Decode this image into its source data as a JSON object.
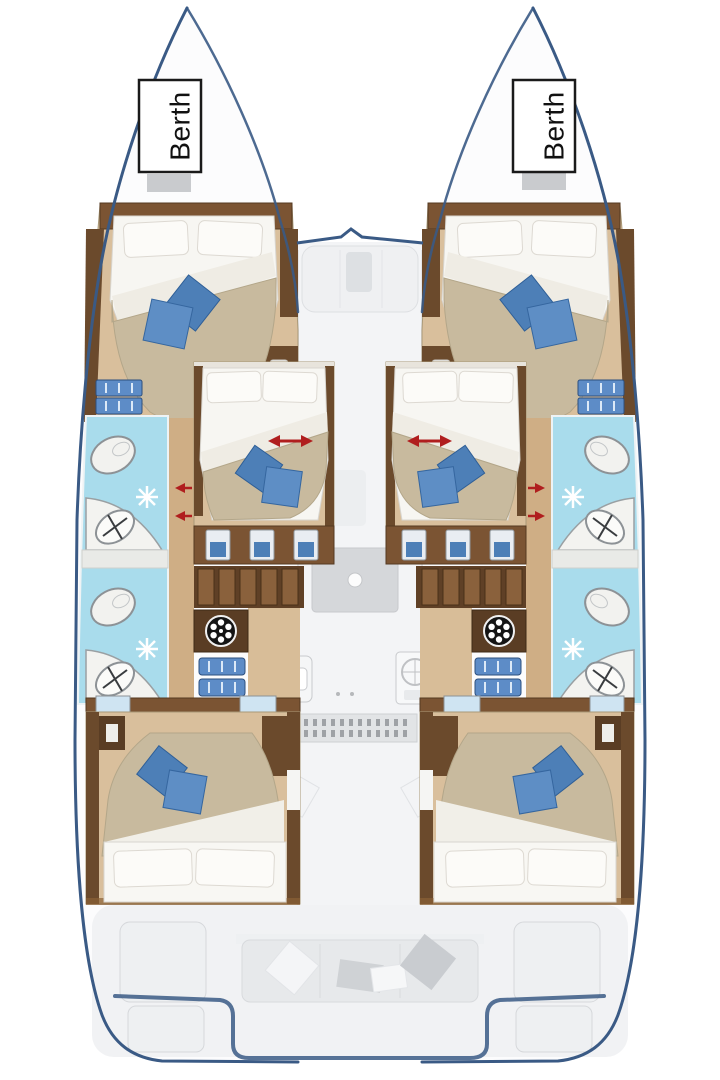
{
  "page": {
    "type": "catamaran-interior-deck-plan",
    "background": "#ffffff",
    "width_px": 720,
    "height_px": 1080
  },
  "labels": {
    "port_berth": "Berth",
    "starboard_berth": "Berth"
  },
  "colors": {
    "hull_outline": "#3a5a85",
    "hull_fill": "#fcfcfd",
    "deck_ghost": "#f2f3f5",
    "deck_furniture": "#d5d7da",
    "wood_wall_dark": "#5f4026",
    "wood_wall": "#6b4a2c",
    "wood_wall_light": "#7b5433",
    "wood_floor": "#d9bf9c",
    "wood_corridor": "#cfae85",
    "bed_linen": "#f7f6f2",
    "bed_duvet": "#c8ba9e",
    "pillow_blue": "#4d7fb7",
    "pillow_blue_light": "#5e8ec5",
    "pillow_gray": "#cfd2d5",
    "bath_floor": "#a9dcec",
    "fixture_white": "#f3f3f0",
    "steps_blue": "#5d8cc7",
    "arrow_red": "#b01e1e",
    "label_box_border": "#1a1a1a",
    "berth_block_gray": "#c9cbce"
  },
  "icons": [
    "toilet-icon",
    "sink-basin-icon",
    "shower-starburst-icon",
    "washing-machine-icon",
    "stove-burner-icon",
    "galley-sink-icon",
    "companionway-steps-icon",
    "slide-direction-arrow-icon",
    "door-arrow-icon"
  ],
  "rooms": {
    "port_hull": [
      "forepeak-berth",
      "forward-cabin",
      "forward-bathroom",
      "aft-bathroom",
      "midship-cabin",
      "aft-cabin"
    ],
    "starboard_hull": [
      "forepeak-berth",
      "forward-cabin",
      "forward-bathroom",
      "aft-bathroom",
      "midship-cabin",
      "aft-cabin"
    ],
    "center": [
      "foredeck-seat",
      "saloon-table",
      "galley",
      "nav-instrument-panel",
      "aft-cockpit-bench",
      "swim-platforms"
    ]
  }
}
